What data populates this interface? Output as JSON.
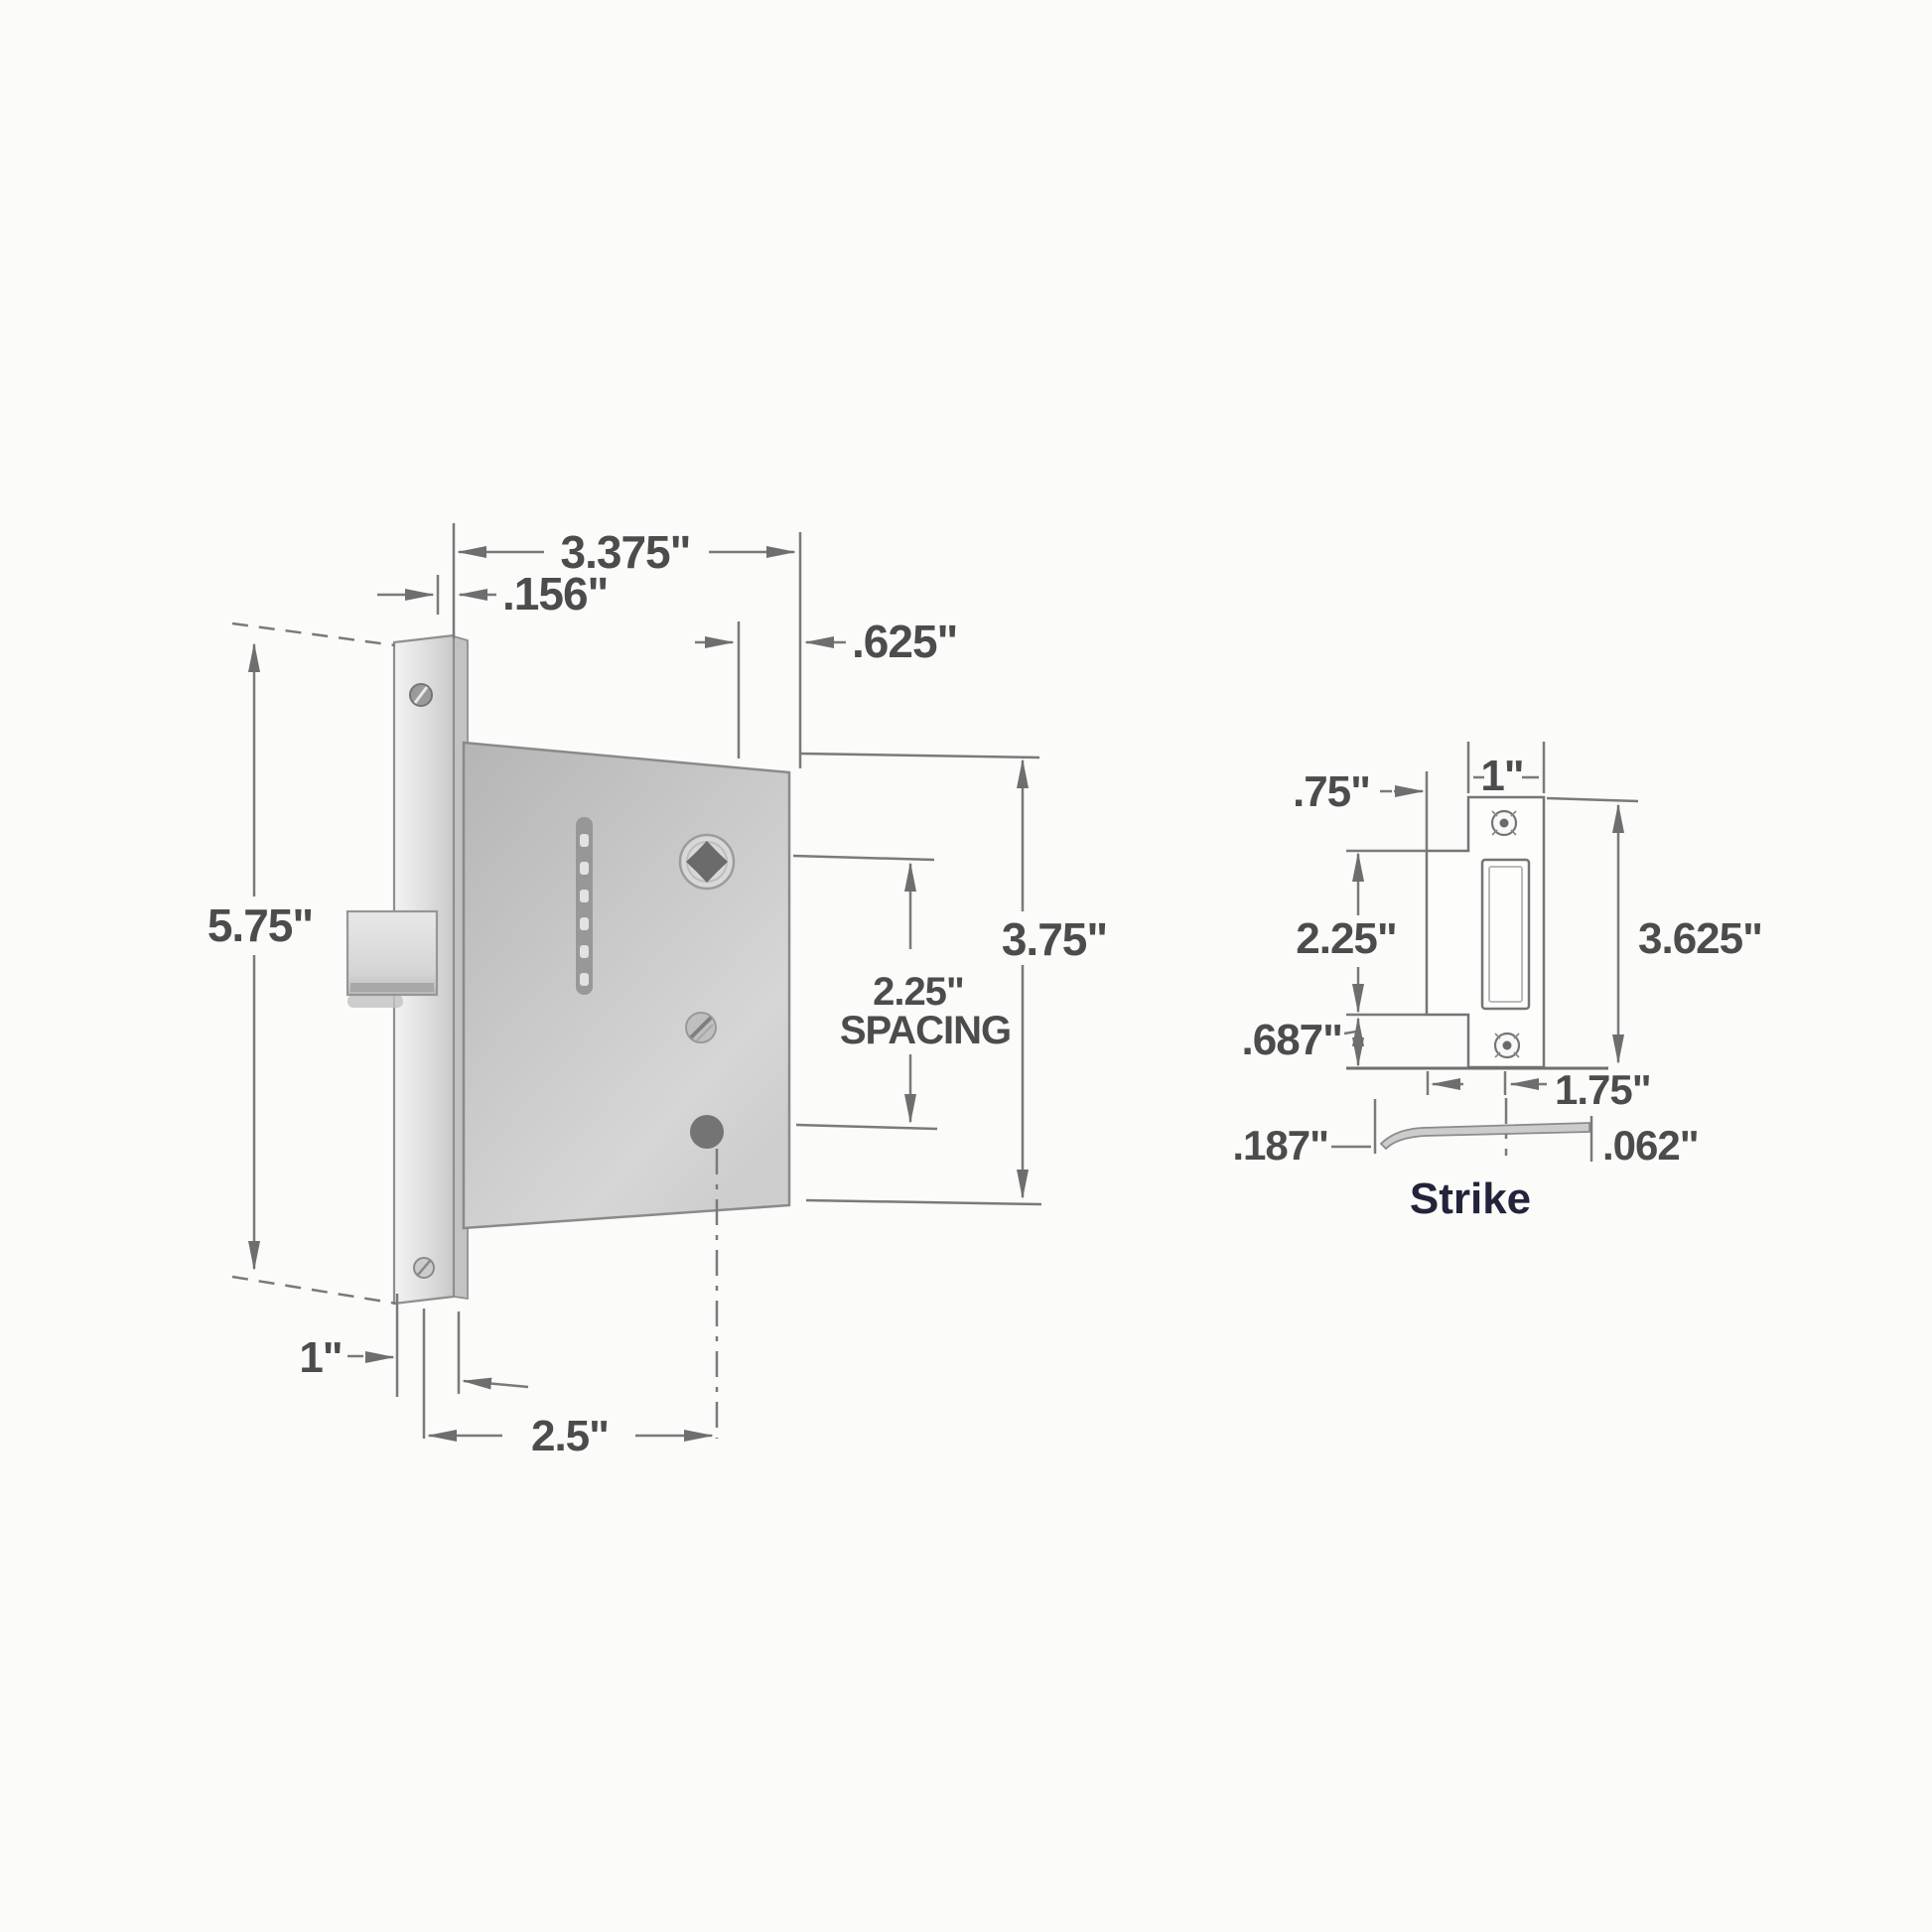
{
  "drawing_title": "mortise lock and strike dimensional diagram",
  "colors": {
    "paper": "#fbfbfa",
    "line": "#7a7a7a",
    "label_text": "#4c4c4c",
    "metal_light": "#ececec",
    "metal_mid": "#c7c7c7",
    "metal_dark": "#8f8f8f",
    "hole_dark": "#717171",
    "caption_text": "#23233b"
  },
  "lock": {
    "dims": {
      "case_width": "3.375\"",
      "faceplate_thickness": ".156\"",
      "hub_offset": ".625\"",
      "faceplate_height": "5.75\"",
      "spacing": "2.25\"",
      "spacing_label": "SPACING",
      "case_height": "3.75\"",
      "faceplate_width": "1\"",
      "backset": "2.5\""
    }
  },
  "strike": {
    "caption": "Strike",
    "dims": {
      "lip_offset": ".75\"",
      "plate_width": "1\"",
      "mid_height": "2.25\"",
      "plate_height": "3.625\"",
      "lower_offset": ".687\"",
      "lip_length": "1.75\"",
      "lip_projection": ".187\"",
      "plate_thickness": ".062\""
    }
  }
}
